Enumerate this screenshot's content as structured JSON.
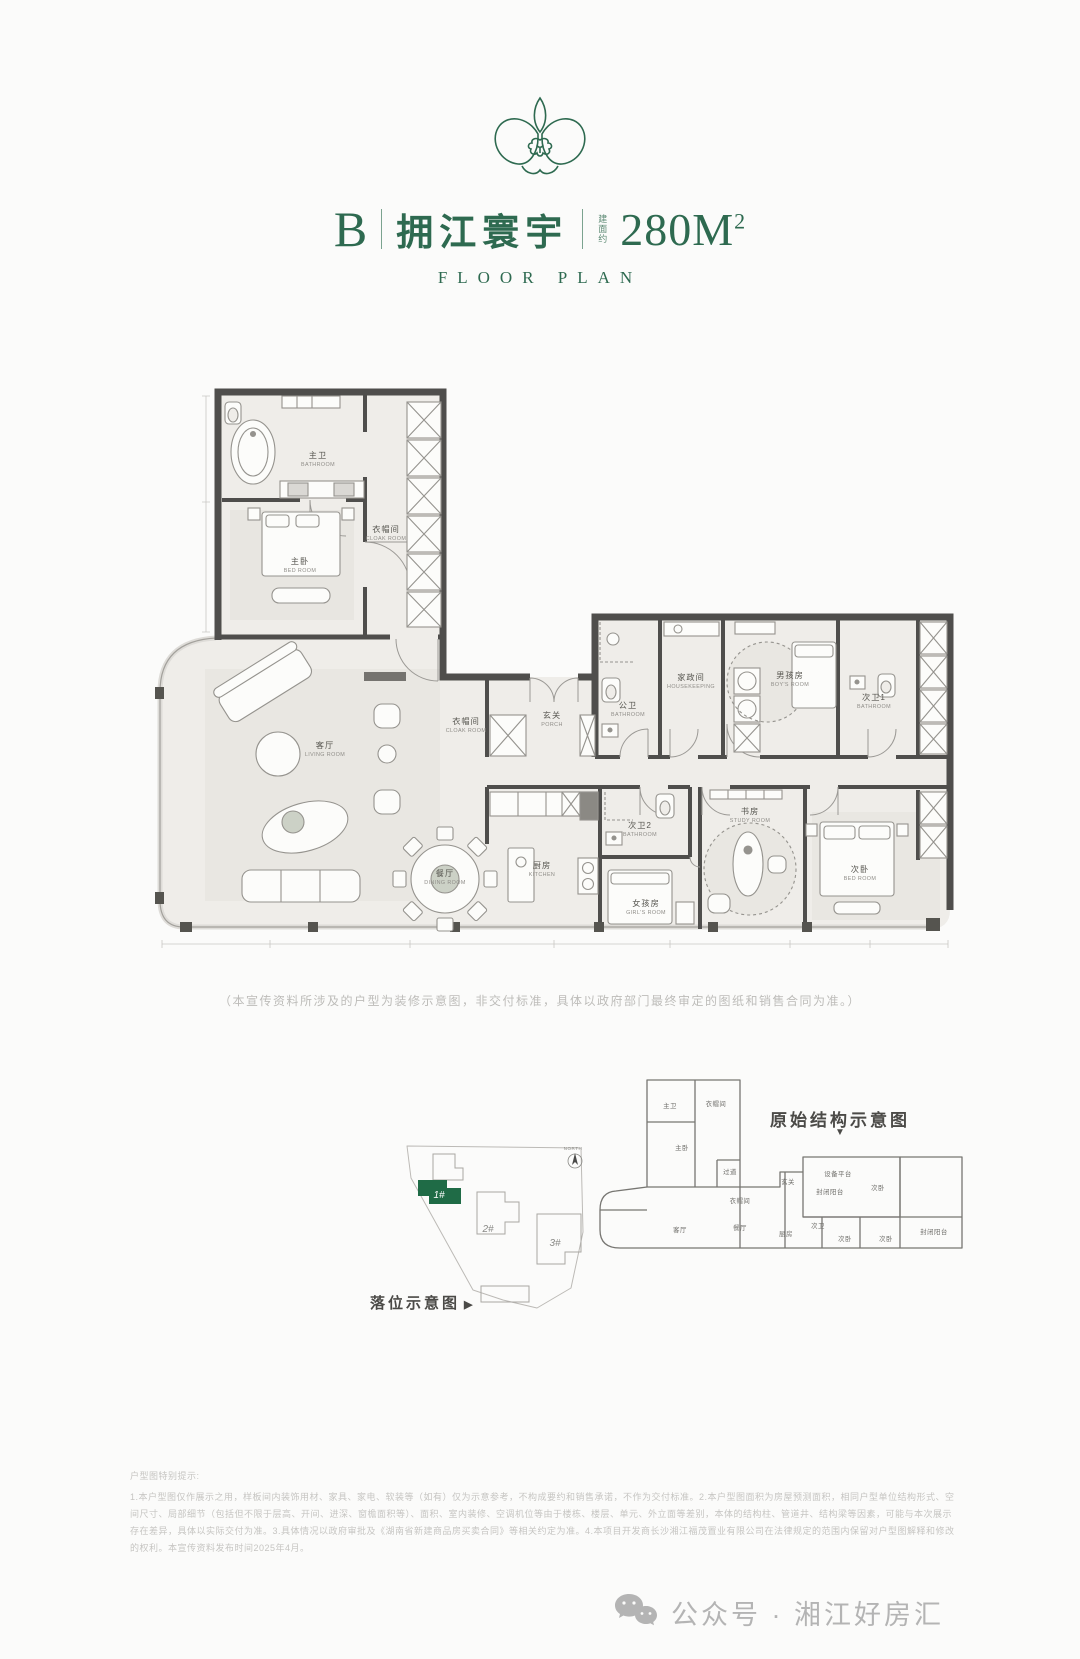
{
  "header": {
    "unit_label": "B",
    "project_name": "拥江寰宇",
    "area_prefix": "建面约",
    "area_value": "280M",
    "area_exponent": "2",
    "subtitle": "FLOOR PLAN"
  },
  "floorplan": {
    "disclaimer": "（本宣传资料所涉及的户型为装修示意图，非交付标准，具体以政府部门最终审定的图纸和销售合同为准。）",
    "rooms": [
      {
        "cn": "主卫",
        "en": "BATHROOM",
        "x": 168,
        "y": 76
      },
      {
        "cn": "衣帽间",
        "en": "CLOAK ROOM",
        "x": 236,
        "y": 150
      },
      {
        "cn": "主卧",
        "en": "BED ROOM",
        "x": 150,
        "y": 182
      },
      {
        "cn": "客厅",
        "en": "LIVING ROOM",
        "x": 175,
        "y": 366
      },
      {
        "cn": "餐厅",
        "en": "DINING ROOM",
        "x": 295,
        "y": 494
      },
      {
        "cn": "玄关",
        "en": "PORCH",
        "x": 402,
        "y": 336
      },
      {
        "cn": "衣帽间",
        "en": "CLOAK ROOM",
        "x": 316,
        "y": 342
      },
      {
        "cn": "公卫",
        "en": "BATHROOM",
        "x": 478,
        "y": 326
      },
      {
        "cn": "家政间",
        "en": "HOUSEKEEPING",
        "x": 541,
        "y": 298
      },
      {
        "cn": "男孩房",
        "en": "BOY'S ROOM",
        "x": 640,
        "y": 296
      },
      {
        "cn": "次卫1",
        "en": "BATHROOM",
        "x": 724,
        "y": 318
      },
      {
        "cn": "厨房",
        "en": "KITCHEN",
        "x": 392,
        "y": 486
      },
      {
        "cn": "次卫2",
        "en": "BATHROOM",
        "x": 490,
        "y": 446
      },
      {
        "cn": "女孩房",
        "en": "GIRL'S ROOM",
        "x": 496,
        "y": 524
      },
      {
        "cn": "书房",
        "en": "STUDY ROOM",
        "x": 600,
        "y": 432
      },
      {
        "cn": "次卧",
        "en": "BED ROOM",
        "x": 710,
        "y": 490
      }
    ]
  },
  "site_plan": {
    "caption": "落位示意图",
    "caption_arrow": "▶",
    "labels": [
      {
        "t": "1#",
        "x": 54,
        "y": 58,
        "cls": "b-lab-hl"
      },
      {
        "t": "2#",
        "x": 103,
        "y": 92,
        "cls": "b-lab"
      },
      {
        "t": "3#",
        "x": 170,
        "y": 106,
        "cls": "b-lab"
      },
      {
        "t": "NORTH",
        "x": 188,
        "y": 10,
        "cls": "n-lab"
      }
    ]
  },
  "structure": {
    "title": "原始结构示意图",
    "arrow": "▼",
    "labels": [
      {
        "t": "主卫",
        "x": 80,
        "y": 48
      },
      {
        "t": "衣帽间",
        "x": 126,
        "y": 46
      },
      {
        "t": "主卧",
        "x": 92,
        "y": 90
      },
      {
        "t": "过道",
        "x": 140,
        "y": 114
      },
      {
        "t": "衣帽间",
        "x": 150,
        "y": 143
      },
      {
        "t": "玄关",
        "x": 198,
        "y": 124
      },
      {
        "t": "设备平台",
        "x": 248,
        "y": 116
      },
      {
        "t": "封闭阳台",
        "x": 240,
        "y": 134
      },
      {
        "t": "次卧",
        "x": 288,
        "y": 130
      },
      {
        "t": "客厅",
        "x": 90,
        "y": 172
      },
      {
        "t": "餐厅",
        "x": 150,
        "y": 170
      },
      {
        "t": "厨房",
        "x": 196,
        "y": 176
      },
      {
        "t": "次卫",
        "x": 228,
        "y": 168
      },
      {
        "t": "次卧",
        "x": 255,
        "y": 181
      },
      {
        "t": "次卧",
        "x": 296,
        "y": 181
      },
      {
        "t": "封闭阳台",
        "x": 344,
        "y": 174
      }
    ]
  },
  "notes": {
    "title": "户型图特别提示:",
    "body": "1.本户型图仅作展示之用，样板间内装饰用材、家具、家电、软装等（如有）仅为示意参考，不构成要约和销售承诺，不作为交付标准。2.本户型图面积为房屋预测面积，相同户型单位结构形式、空间尺寸、局部细节（包括但不限于层高、开间、进深、窗檐面积等）、面积、室内装修、空调机位等由于楼栋、楼层、单元、外立面等差别，本体的结构柱、管道井、结构梁等因素，可能与本次展示存在差异，具体以实际交付为准。3.具体情况以政府审批及《湖南省新建商品房买卖合同》等相关约定为准。4.本项目开发商长沙湘江福茂置业有限公司在法律规定的范围内保留对户型图解释和修改的权利。本宣传资料发布时间2025年4月。"
  },
  "footer": {
    "text": "公众号 · 湘江好房汇"
  },
  "colors": {
    "brand_green": "#2e6a50",
    "building_green": "#1f6b46",
    "wall": "#4f4e4c"
  }
}
